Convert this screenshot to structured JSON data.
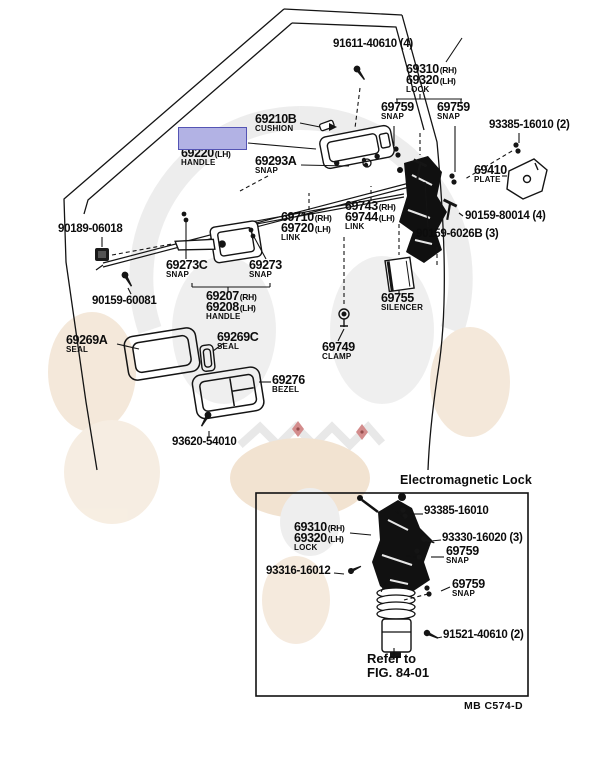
{
  "parts": {
    "screw_91611": "91611-40610 (4)",
    "lock": {
      "n1": "69310",
      "t1": "(RH)",
      "n2": "69320",
      "t2": "(LH)",
      "name": "LOCK"
    },
    "snap_left": {
      "num": "69759",
      "name": "SNAP"
    },
    "snap_right": {
      "num": "69759",
      "name": "SNAP"
    },
    "clip_93385": "93385-16010 (2)",
    "cushion": {
      "num": "69210B",
      "name": "CUSHION"
    },
    "outside_handle": {
      "n1": "69210",
      "t1": "(RH)",
      "n2": "69220",
      "t2": "(LH)",
      "name": "HANDLE"
    },
    "snap_69293a": {
      "num": "69293A",
      "name": "SNAP"
    },
    "plate": {
      "num": "69410",
      "name": "PLATE"
    },
    "link_front": {
      "n1": "69710",
      "t1": "(RH)",
      "n2": "69720",
      "t2": "(LH)",
      "name": "LINK"
    },
    "link_rear": {
      "n1": "69743",
      "t1": "(RH)",
      "n2": "69744",
      "t2": "(LH)",
      "name": "LINK"
    },
    "pin_80014": "90159-80014 (4)",
    "pin_6026b": "90159-6026B (3)",
    "grommet_06018": "90189-06018",
    "snap_69273c": {
      "num": "69273C",
      "name": "SNAP"
    },
    "snap_69273": {
      "num": "69273",
      "name": "SNAP"
    },
    "inside_handle": {
      "n1": "69207",
      "t1": "(RH)",
      "n2": "69208",
      "t2": "(LH)",
      "name": "HANDLE"
    },
    "screw_60081": "90159-60081",
    "silencer": {
      "num": "69755",
      "name": "SILENCER"
    },
    "seal_a": {
      "num": "69269A",
      "name": "SEAL"
    },
    "seal_c": {
      "num": "69269C",
      "name": "SEAL"
    },
    "clamp": {
      "num": "69749",
      "name": "CLAMP"
    },
    "bezel": {
      "num": "69276",
      "name": "BEZEL"
    },
    "screw_54010": "93620-54010"
  },
  "inset": {
    "title": "Electromagnetic Lock",
    "clip_16010": "93385-16010",
    "lock": {
      "n1": "69310",
      "t1": "(RH)",
      "n2": "69320",
      "t2": "(LH)",
      "name": "LOCK"
    },
    "screw_16020": "93330-16020 (3)",
    "snap_upper": {
      "num": "69759",
      "name": "SNAP"
    },
    "screw_16012": "93316-16012",
    "snap_lower": {
      "num": "69759",
      "name": "SNAP"
    },
    "screw_40610": "91521-40610 (2)",
    "refer_line1": "Refer to",
    "refer_line2": "FIG. 84-01"
  },
  "footer_code": "MB C574-D",
  "highlight": {
    "fill": "#b2b2e4",
    "border": "#5454b4"
  }
}
